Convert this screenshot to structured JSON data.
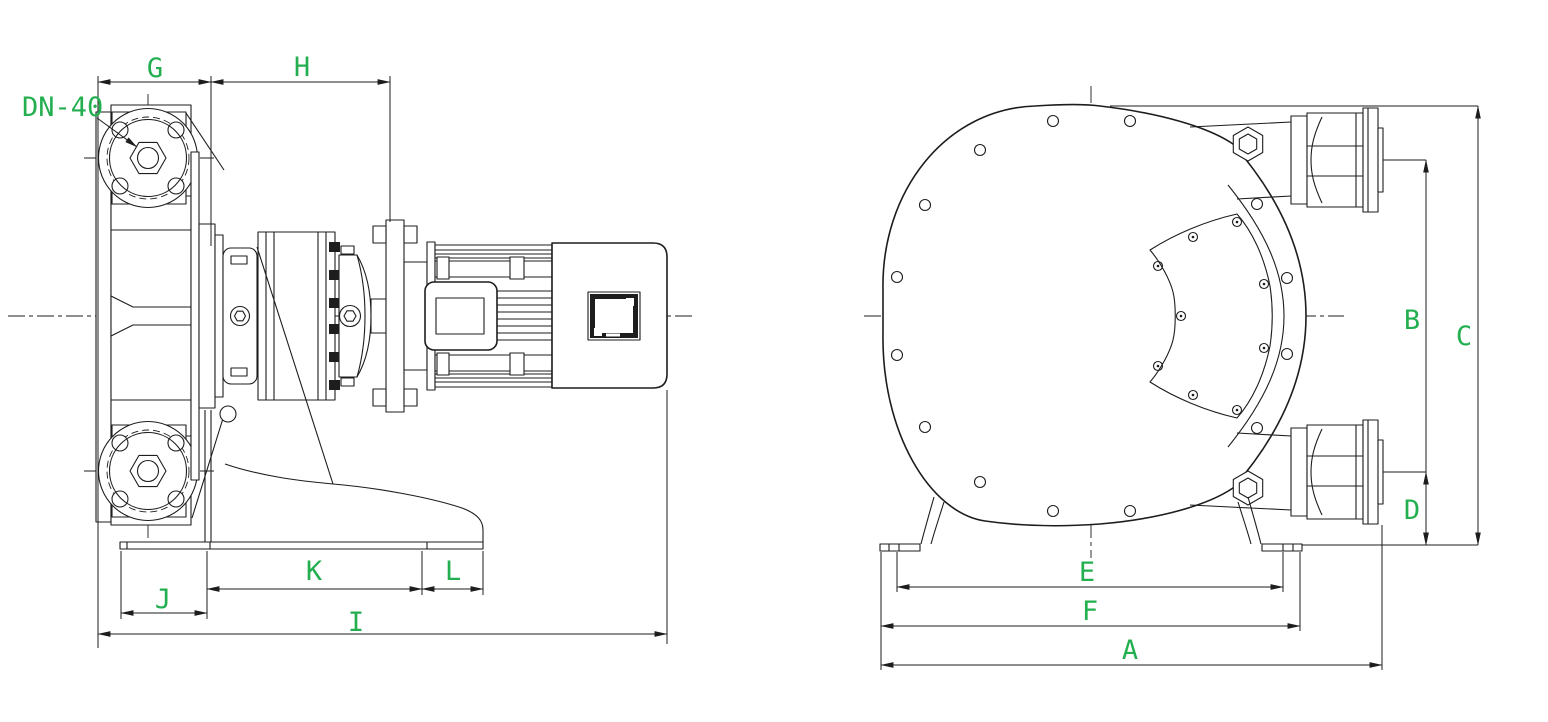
{
  "colors": {
    "annotation_green": "#23af50",
    "line_ink": "#1d1d1d",
    "background": "#ffffff"
  },
  "drawing": {
    "port_size_label": "DN-40",
    "dimension_labels": {
      "A": "A",
      "B": "B",
      "C": "C",
      "D": "D",
      "E": "E",
      "F": "F",
      "G": "G",
      "H": "H",
      "I": "I",
      "J": "J",
      "K": "K",
      "L": "L"
    }
  }
}
